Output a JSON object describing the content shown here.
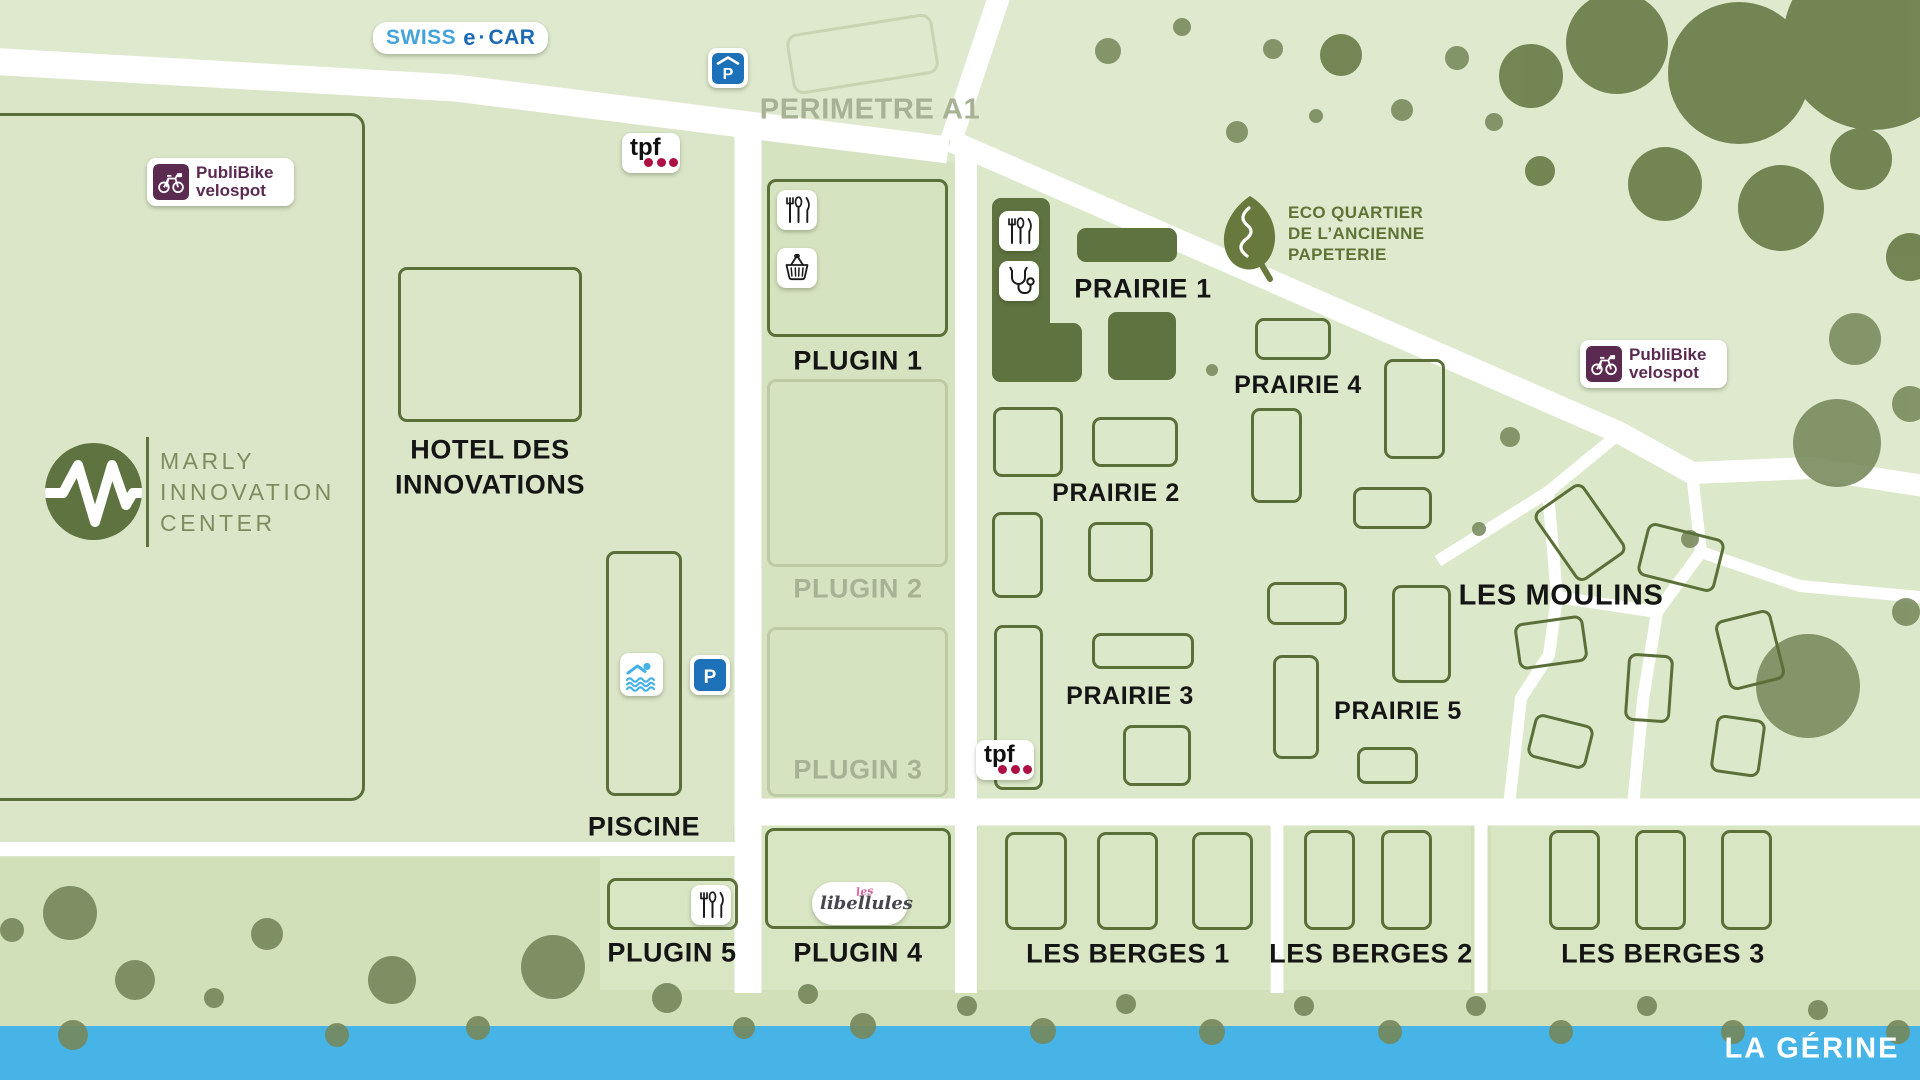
{
  "zones": {
    "perimetre": "PERIMETRE A1",
    "hotel": {
      "line1": "HOTEL DES",
      "line2": "INNOVATIONS"
    },
    "piscine": "PISCINE",
    "plugin1": "PLUGIN 1",
    "plugin2": "PLUGIN 2",
    "plugin3": "PLUGIN 3",
    "plugin4": "PLUGIN 4",
    "plugin5": "PLUGIN 5",
    "prairie1": "PRAIRIE 1",
    "prairie2": "PRAIRIE 2",
    "prairie3": "PRAIRIE 3",
    "prairie4": "PRAIRIE 4",
    "prairie5": "PRAIRIE 5",
    "moulins": "LES MOULINS",
    "berges1": "LES BERGES 1",
    "berges2": "LES BERGES 2",
    "berges3": "LES BERGES 3",
    "river": "LA GÉRINE"
  },
  "logos": {
    "swiss_ecar": {
      "word1": "SWISS",
      "word2": "e",
      "dot": "·",
      "word3": "CAR"
    },
    "publibike": {
      "line1": "PubliBike",
      "line2": "velospot"
    },
    "tpf": "tpf",
    "marly": {
      "line1": "MARLY",
      "line2": "INNOVATION",
      "line3": "CENTER"
    },
    "eco": {
      "line1": "ECO QUARTIER",
      "line2": "DE L’ANCIENNE",
      "line3": "PAPETERIE"
    },
    "libellules": {
      "prefix": "les",
      "name": "libellules"
    },
    "parking": "P"
  },
  "colors": {
    "building_fill": "#5f7340",
    "building_stroke": "#5a7038",
    "road": "#ffffff",
    "river": "#47b4e8",
    "tree": "#74875a",
    "publibike_purple": "#5b2a51",
    "tpf_red": "#ad1144",
    "ecar_blue_light": "#44a3da",
    "ecar_blue_dark": "#1b6ab3",
    "parking_blue": "#1d71b8",
    "swim_blue": "#45b2e6",
    "grey_label": "#a7b295",
    "olive_text": "#7d8c5f"
  }
}
